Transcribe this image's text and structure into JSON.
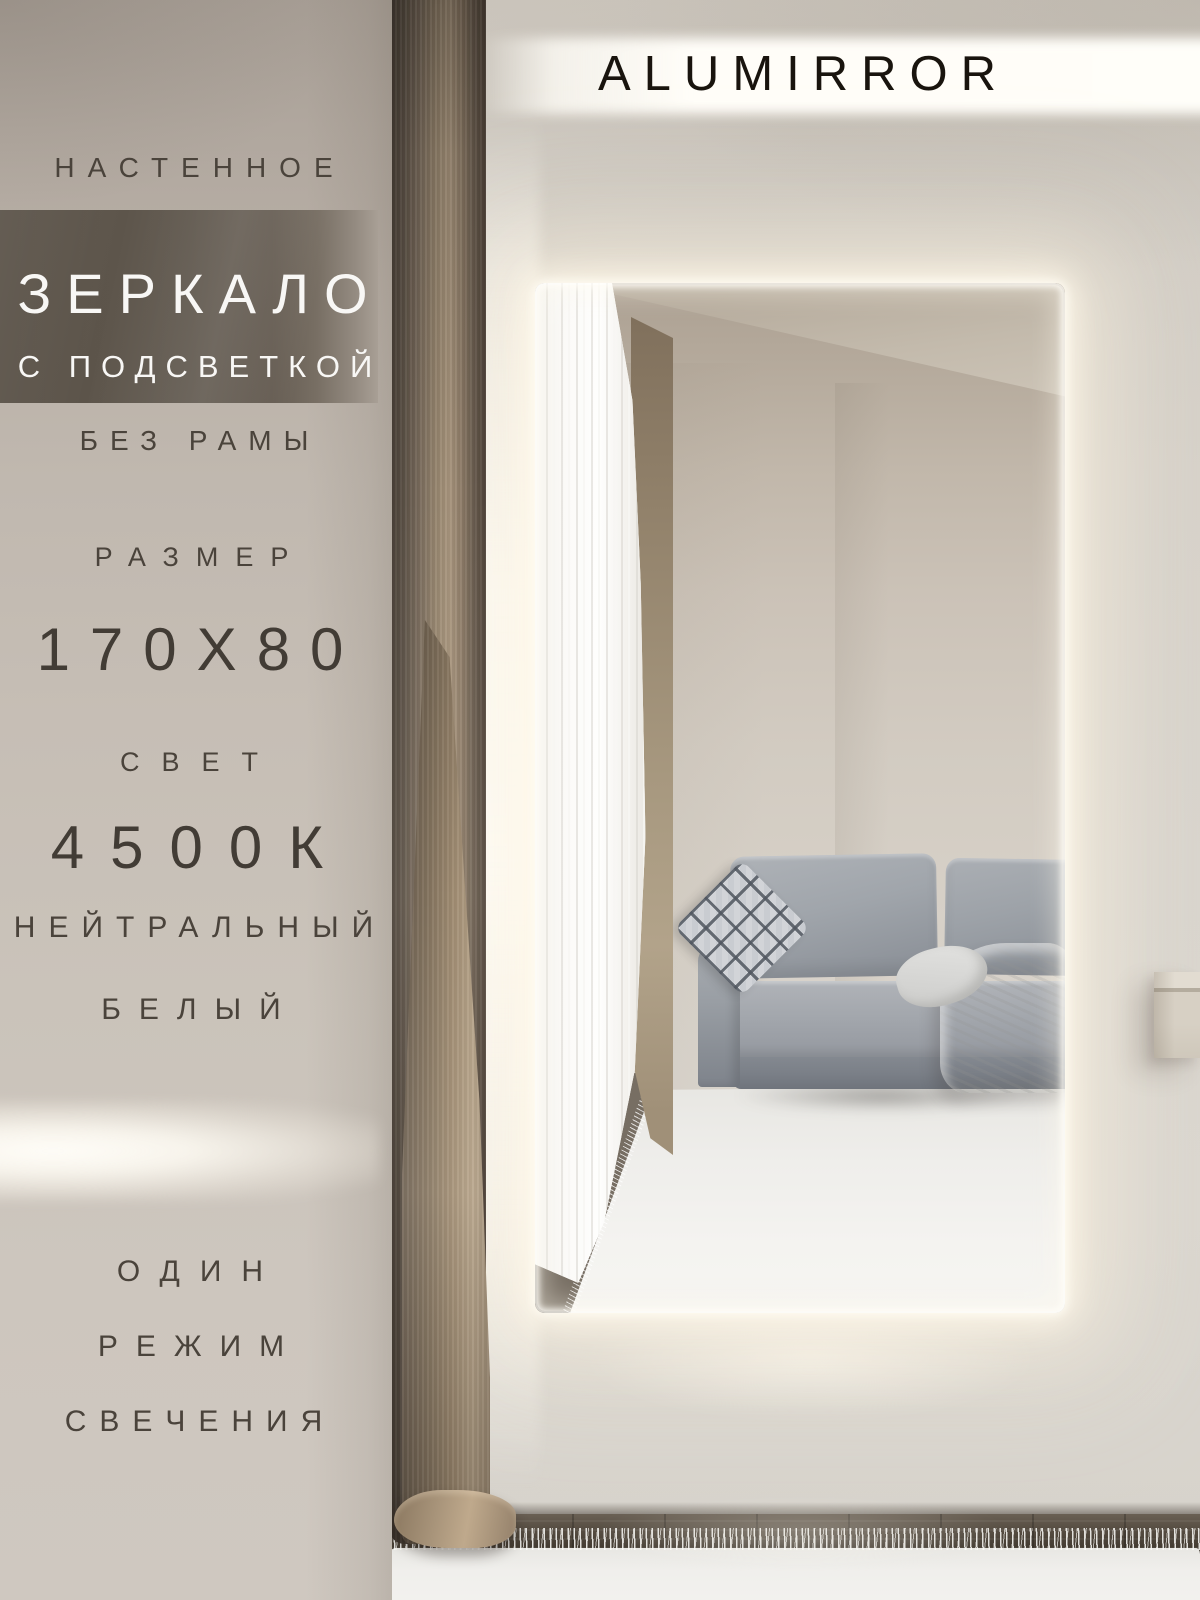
{
  "brand": {
    "name": "ALUMIRROR"
  },
  "panel": {
    "kicker": "НАСТЕННОЕ",
    "title": "ЗЕРКАЛО",
    "subtitle": "С ПОДСВЕТКОЙ",
    "frameless": "БЕЗ РАМЫ",
    "size_label": "РАЗМЕР",
    "size_value": "170X80",
    "light_label": "СВЕТ",
    "light_value": "4500К",
    "light_desc_1": "НЕЙТРАЛЬНЫЙ",
    "light_desc_2": "БЕЛЫЙ",
    "mode_line_1": "ОДИН",
    "mode_line_2": "РЕЖИМ",
    "mode_line_3": "СВЕЧЕНИЯ"
  },
  "palette": {
    "wall_left": "#c3bbb2",
    "wall_right": "#d6d1ca",
    "title_band": "#5e564c",
    "text_dark": "#4a433b",
    "text_light": "#f8f7f5",
    "led_glow": "#fff6e2",
    "sofa_gray": "#9aa0a7",
    "curtain_brown": "#8a7a66",
    "rug_white": "#f0efec",
    "floor_dark": "#463e34"
  }
}
